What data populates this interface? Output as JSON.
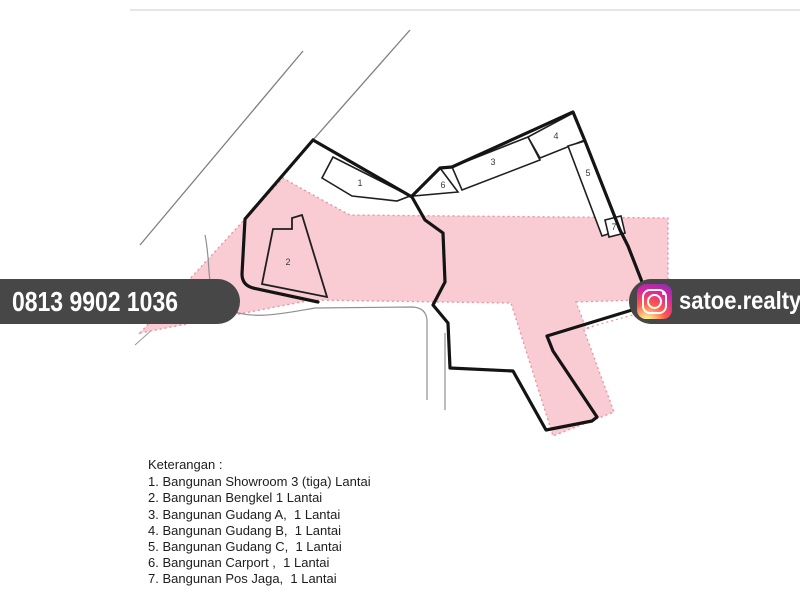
{
  "phone_badge": {
    "number": "0813 9902 1036"
  },
  "instagram_badge": {
    "handle": "satoe.realty",
    "icon": "instagram-logo"
  },
  "legend": {
    "title": "Keterangan :",
    "items": [
      "1. Bangunan Showroom 3 (tiga) Lantai",
      "2. Bangunan Bengkel 1 Lantai",
      "3. Bangunan Gudang A,  1 Lantai",
      "4. Bangunan Gudang B,  1 Lantai",
      "5. Bangunan Gudang C,  1 Lantai",
      "6. Bangunan Carport ,  1 Lantai",
      "7. Bangunan Pos Jaga,  1 Lantai"
    ]
  },
  "plan": {
    "building_labels": [
      "1",
      "2",
      "3",
      "4",
      "5",
      "6",
      "7"
    ]
  },
  "colors": {
    "site_area_pink": "#f8ccd2",
    "pink_dotted_border": "#e795a1",
    "boundary_black": "#141414",
    "building_outline": "#1f1f1f",
    "road_gray": "#8f8f8f",
    "badge_background": "#474747",
    "badge_text": "#ffffff"
  }
}
